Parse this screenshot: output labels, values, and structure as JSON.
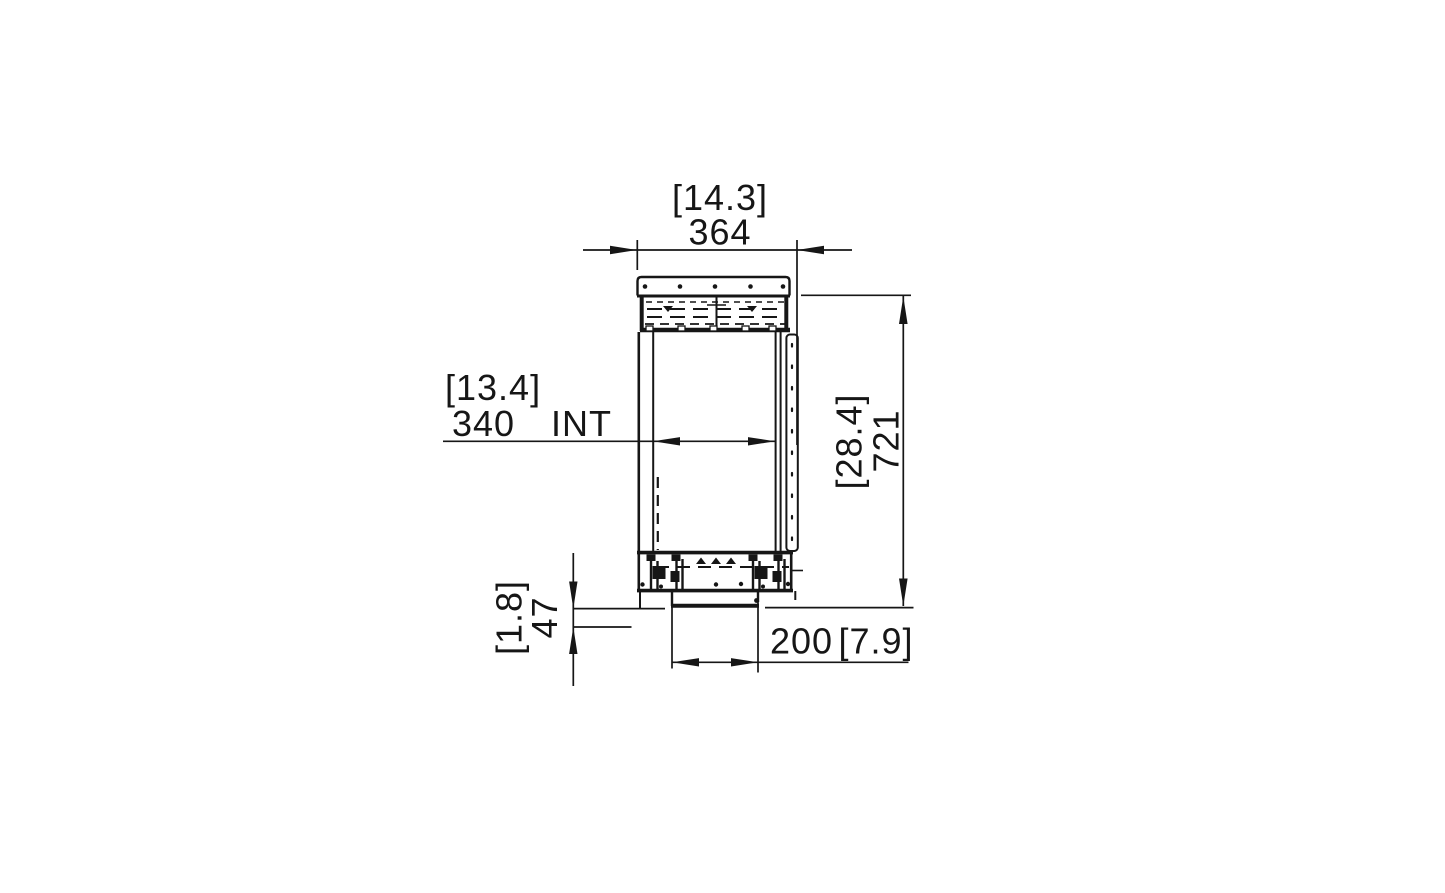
{
  "canvas": {
    "background": "#ffffff",
    "line_color": "#161616"
  },
  "drawing": {
    "dimensions": {
      "overall_width": {
        "value": "364",
        "bracketed": "[14.3]"
      },
      "internal_width": {
        "value": "340",
        "suffix": "INT",
        "bracketed": "[13.4]"
      },
      "overall_height": {
        "value": "721",
        "bracketed": "[28.4]"
      },
      "base_height": {
        "value": "47",
        "bracketed": "[1.8]"
      },
      "base_width": {
        "value": "200",
        "bracketed": "[7.9]"
      }
    }
  }
}
